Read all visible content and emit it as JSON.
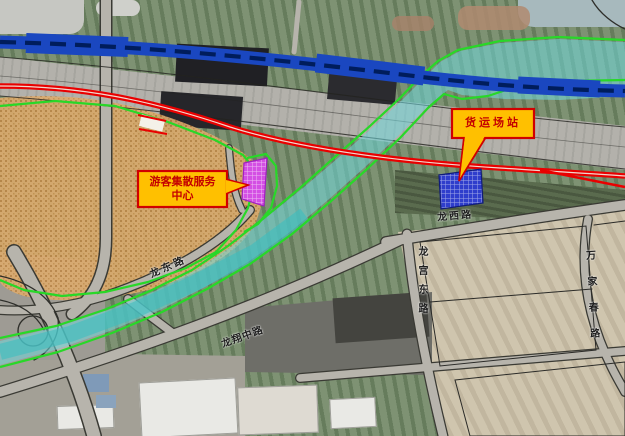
{
  "map": {
    "callouts": {
      "tourist_center": {
        "line1": "游客集散服务",
        "line2": "中心"
      },
      "freight_station": {
        "label": "货运场站"
      }
    },
    "road_labels": {
      "long_dong_road": "龙东路",
      "long_xi_road": "龙西路",
      "long_gong_east_road": "龙宫东路",
      "wan_jia_chun_road": "万家春路",
      "long_xiang_middle_road": "龙翔中路"
    },
    "overlay_colors": {
      "railway_blue": "#1a47c0",
      "planned_road_red": "#e90000",
      "boundary_green": "#28d828",
      "water_cyan": "#70d8dc",
      "urban_area_orange": "#dcaa6d",
      "tourist_site_magenta": "#d44fe4",
      "freight_site_blue": "#2f3ecc",
      "callout_fill": "#ffc000",
      "callout_border": "#d00000"
    }
  }
}
